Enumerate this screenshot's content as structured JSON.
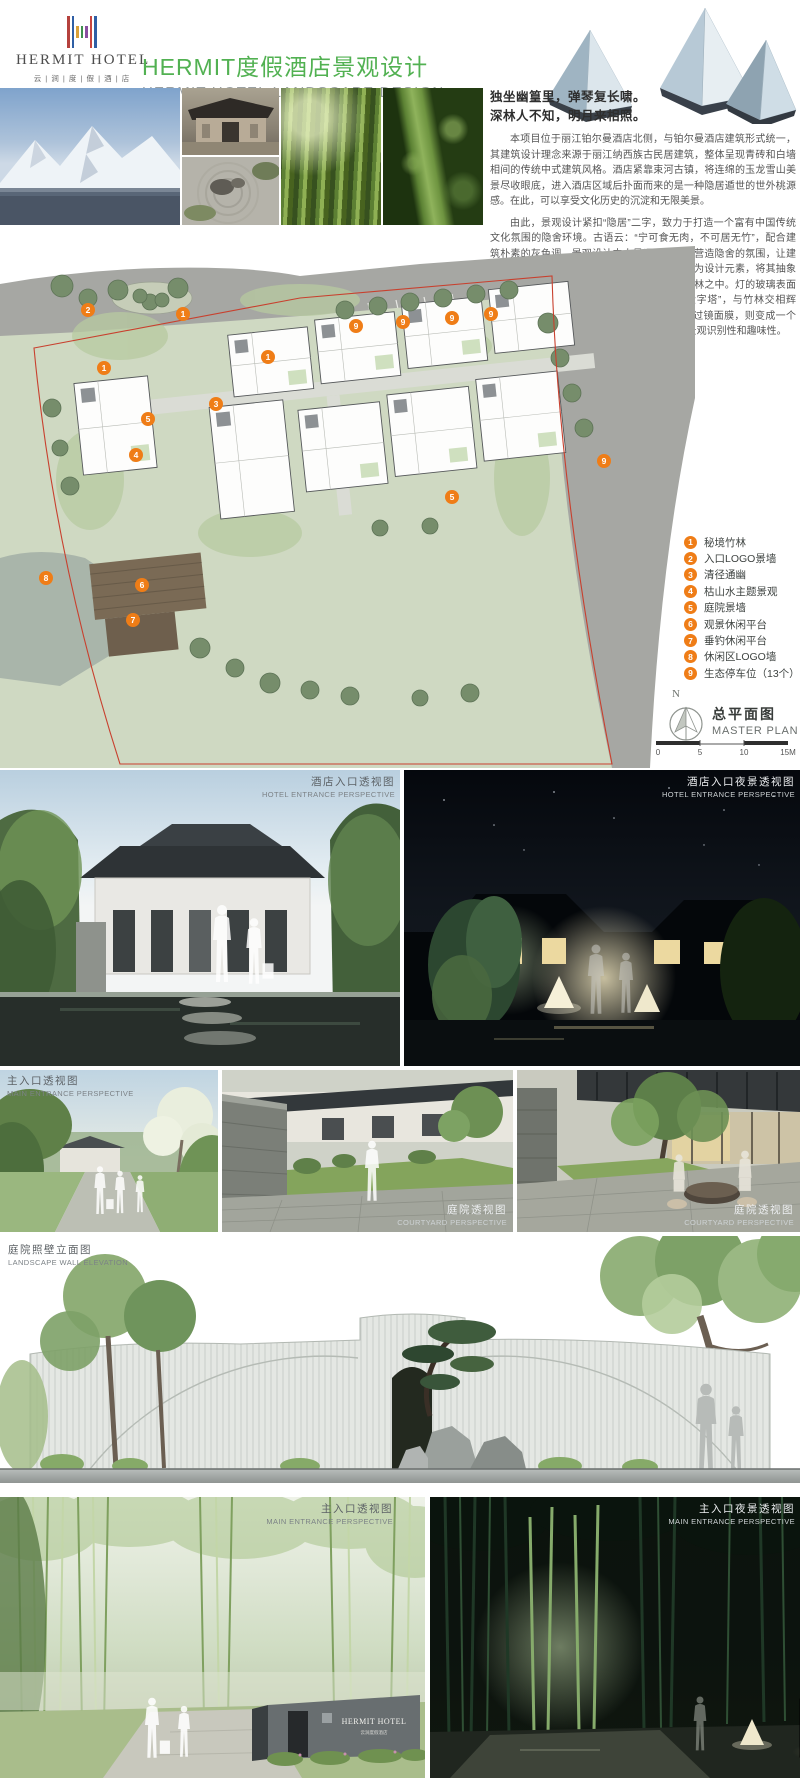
{
  "header": {
    "logo": {
      "brand": "HERMIT HOTEL",
      "sub": "云 | 涧 | 度 | 假 | 酒 | 店"
    },
    "title_cn": "HERMIT度假酒店景观设计",
    "title_en": "HERMIT HOTEL LANDSCAPE DESIGN"
  },
  "intro": {
    "poem1": "独坐幽篁里，弹琴复长啸。",
    "poem2": "深林人不知，明月来相照。",
    "para1": "本项目位于丽江铂尔曼酒店北侧，与铂尔曼酒店建筑形式统一，其建筑设计理念来源于丽江纳西族古民居建筑，整体呈现青砖和白墙相间的传统中式建筑风格。酒店紧靠束河古镇，将连绵的玉龙雪山美景尽收眼底，进入酒店区域后扑面而来的是一种隐居遁世的世外桃源感。在此，可以享受文化历史的沉淀和无限美景。",
    "para2": "由此，景观设计紧扣“隐居”二字，致力于打造一个富有中国传统文化氛围的隐舍环境。古语云：“宁可食无肉，不可居无竹”，配合建筑朴素的灰色调，景观设计中大量运用竹子来营造隐舍的氛围，让建筑在竹林中若隐若现，并运用了丽江玉龙雪山为设计元素，将其抽象提取成为三棱锥体的景观灯具，成组布置在竹林之中。灯的玻璃表面贴镜面膜，白天在竹林中犹如一座座镜面“金字塔”，与竹林交相辉映，形成一种“竹林秘境”的感觉。晚上灯光透过镜面膜，则变成一个个发光的“三角”，在提供功能照明的同时增加景观识别性和趣味性。"
  },
  "plan": {
    "title_cn": "总平面图",
    "title_en": "MASTER PLAN",
    "north": "N",
    "scale_ticks": [
      "0",
      "5",
      "10",
      "15M"
    ],
    "legend": [
      {
        "num": "1",
        "label": "秘境竹林"
      },
      {
        "num": "2",
        "label": "入口LOGO景墙"
      },
      {
        "num": "3",
        "label": "清径通幽"
      },
      {
        "num": "4",
        "label": "枯山水主题景观"
      },
      {
        "num": "5",
        "label": "庭院景墙"
      },
      {
        "num": "6",
        "label": "观景休闲平台"
      },
      {
        "num": "7",
        "label": "垂钓休闲平台"
      },
      {
        "num": "8",
        "label": "休闲区LOGO墙"
      },
      {
        "num": "9",
        "label": "生态停车位（13个）"
      }
    ],
    "markers": [
      {
        "num": "2"
      },
      {
        "num": "1"
      },
      {
        "num": "1"
      },
      {
        "num": "1"
      },
      {
        "num": "3"
      },
      {
        "num": "5"
      },
      {
        "num": "4"
      },
      {
        "num": "5"
      },
      {
        "num": "9"
      },
      {
        "num": "9"
      },
      {
        "num": "9"
      },
      {
        "num": "9"
      },
      {
        "num": "9"
      },
      {
        "num": "8"
      },
      {
        "num": "6"
      },
      {
        "num": "7"
      }
    ]
  },
  "renders": {
    "hotel_day": {
      "cn": "酒店入口透视图",
      "en": "HOTEL ENTRANCE PERSPECTIVE"
    },
    "hotel_night": {
      "cn": "酒店入口夜景透视图",
      "en": "HOTEL ENTRANCE PERSPECTIVE"
    },
    "main_day": {
      "cn": "主入口透视图",
      "en": "MAIN ENTRANCE PERSPECTIVE"
    },
    "court1": {
      "cn": "庭院透视图",
      "en": "COURTYARD PERSPECTIVE"
    },
    "court2": {
      "cn": "庭院透视图",
      "en": "COURTYARD PERSPECTIVE"
    },
    "elevation": {
      "cn": "庭院照壁立面图",
      "en": "LANDSCAPE WALL ELEVATION"
    },
    "entry_day": {
      "cn": "主入口透视图",
      "en": "MAIN ENTRANCE PERSPECTIVE"
    },
    "entry_night": {
      "cn": "主入口夜景透视图",
      "en": "MAIN ENTRANCE PERSPECTIVE"
    },
    "sign_text": "HERMIT HOTEL",
    "sign_sub": "云涧度假酒店"
  },
  "colors": {
    "accent_green": "#52b152",
    "legend_orange": "#ef7d17",
    "boundary_red": "#c8402e"
  }
}
